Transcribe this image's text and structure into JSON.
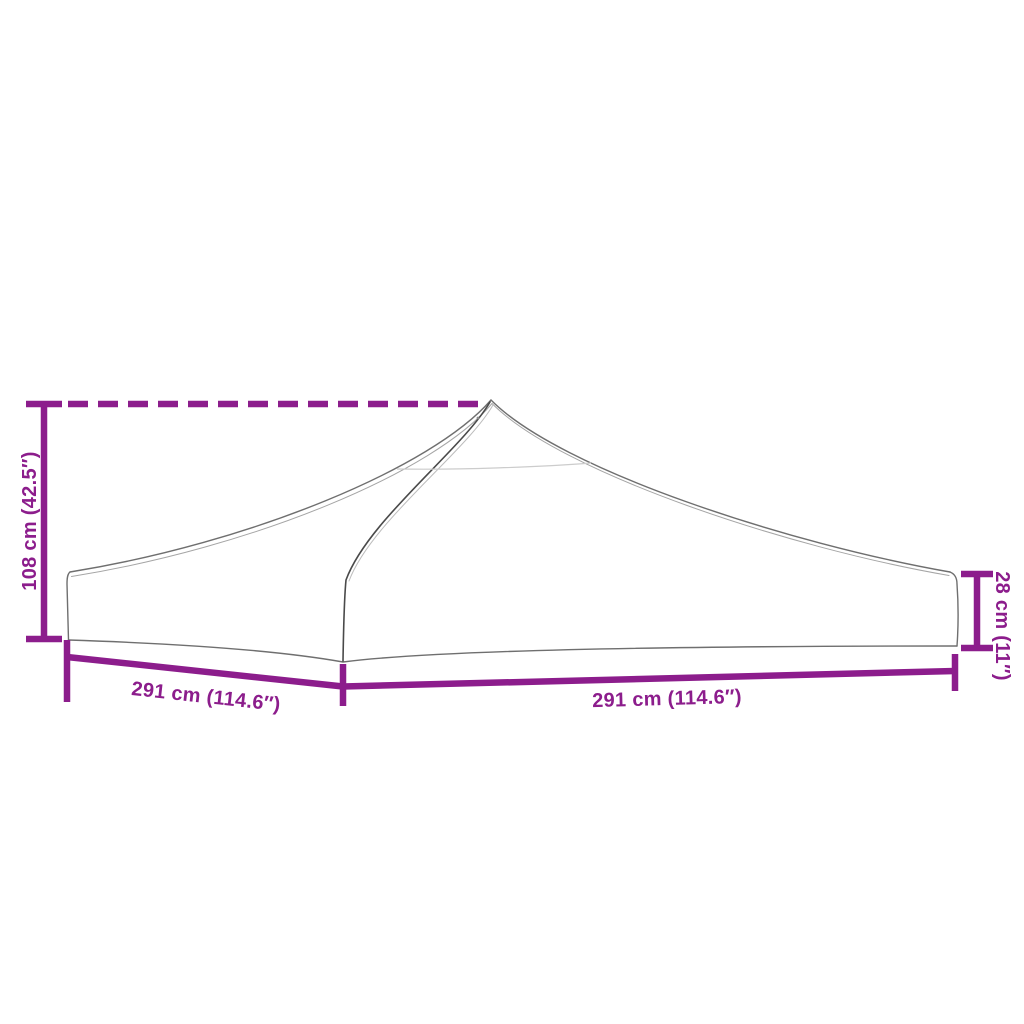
{
  "diagram": {
    "colors": {
      "dimension": "#8C1D8C",
      "outline": "#6f6f6f",
      "seam": "#4a4a4a",
      "faint": "#cccccc",
      "background": "#ffffff"
    },
    "dimensions": {
      "peak_height": {
        "label": "108 cm (42.5″)",
        "cm": 108,
        "inches": 42.5
      },
      "left_base": {
        "label": "291 cm (114.6″)",
        "cm": 291,
        "inches": 114.6
      },
      "right_base": {
        "label": "291 cm (114.6″)",
        "cm": 291,
        "inches": 114.6
      },
      "valance_height": {
        "label": "28 cm (11″)",
        "cm": 28,
        "inches": 11
      }
    }
  }
}
